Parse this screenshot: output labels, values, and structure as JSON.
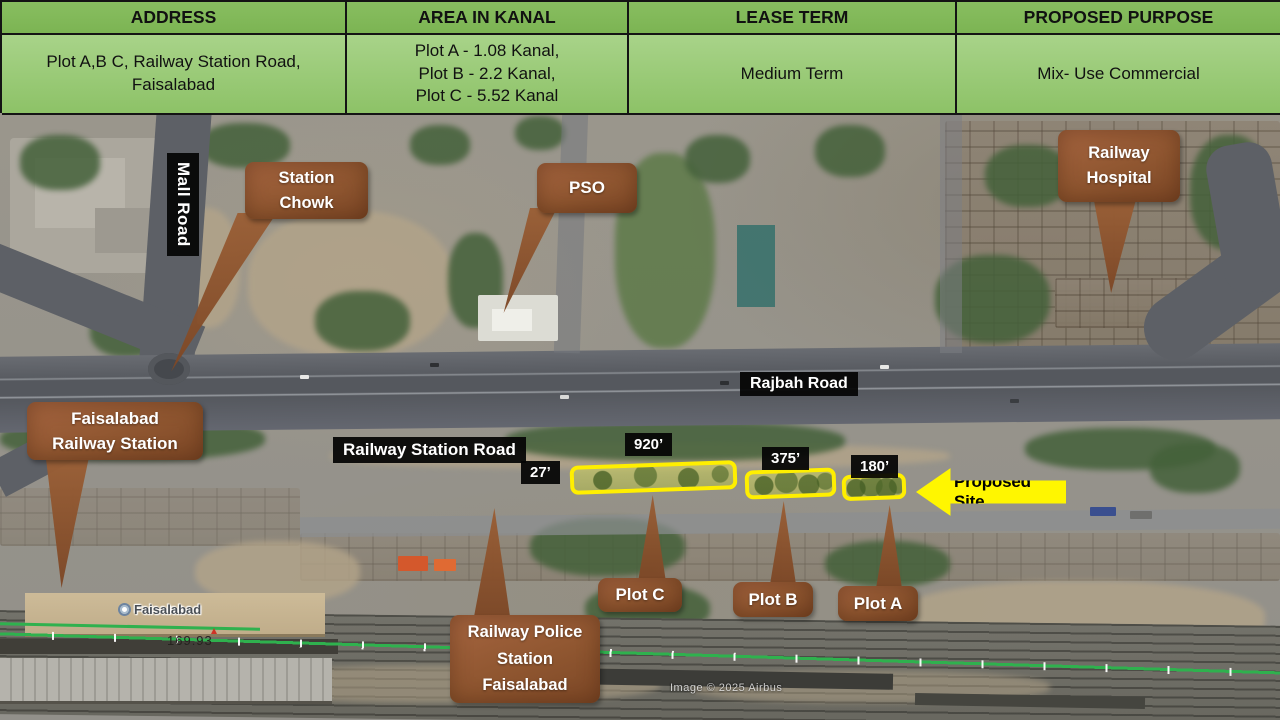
{
  "table": {
    "headers": [
      "ADDRESS",
      "AREA IN KANAL",
      "LEASE  TERM",
      "PROPOSED PURPOSE"
    ],
    "address": "Plot  A,B C, Railway Station Road, Faisalabad",
    "area_lines": [
      "Plot A - 1.08 Kanal,",
      "Plot B - 2.2 Kanal,",
      "Plot C - 5.52 Kanal"
    ],
    "lease_term": "Medium Term",
    "purpose": "Mix- Use Commercial",
    "colors": {
      "header_bg": "#82b95a",
      "row_bg": "#9ccb7c",
      "border": "#141414"
    }
  },
  "map": {
    "road_labels": {
      "mall_road": "Mall Road",
      "rajbah_road": "Rajbah Road",
      "railway_station_road": "Railway Station Road"
    },
    "measurements": {
      "gap": "27’",
      "plot_c": "920’",
      "plot_b": "375’",
      "plot_a": "180’"
    },
    "callouts": {
      "station_chowk": [
        "Station",
        "Chowk"
      ],
      "pso": "PSO",
      "railway_hospital": [
        "Railway",
        "Hospital"
      ],
      "faisalabad_railway_station": [
        "Faisalabad",
        "Railway Station"
      ],
      "plot_c": "Plot C",
      "plot_b": "Plot B",
      "plot_a": "Plot A",
      "railway_police": [
        "Railway Police",
        "Station",
        "Faisalabad"
      ]
    },
    "proposed_site_label": "Proposed Site",
    "poi_faisalabad": "Faisalabad",
    "poi_icon": "train-station-icon",
    "track_number": "169.93",
    "attribution": "Image © 2025 Airbus",
    "colors": {
      "callout_brown": "#96572f",
      "plot_outline": "#ffef00",
      "arrow_yellow": "#fff600",
      "label_bg": "#050505"
    }
  }
}
